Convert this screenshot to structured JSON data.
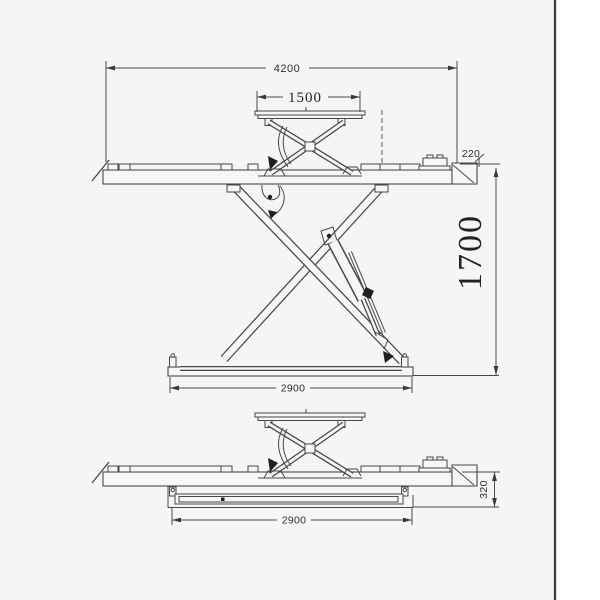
{
  "page": {
    "background": "#f5f5f3",
    "paper_strip": "#ffffff",
    "border_line_color": "#3c3c3c",
    "line_color": "#474747",
    "text_color": "#2e2e2e"
  },
  "dims": {
    "overall_length": "4200",
    "aux_platform_length": "1500",
    "platform_edge_height": "220",
    "raised_height": "1700",
    "base_length": "2900",
    "lowered_height": "320",
    "base_length_lowered": "2900"
  }
}
